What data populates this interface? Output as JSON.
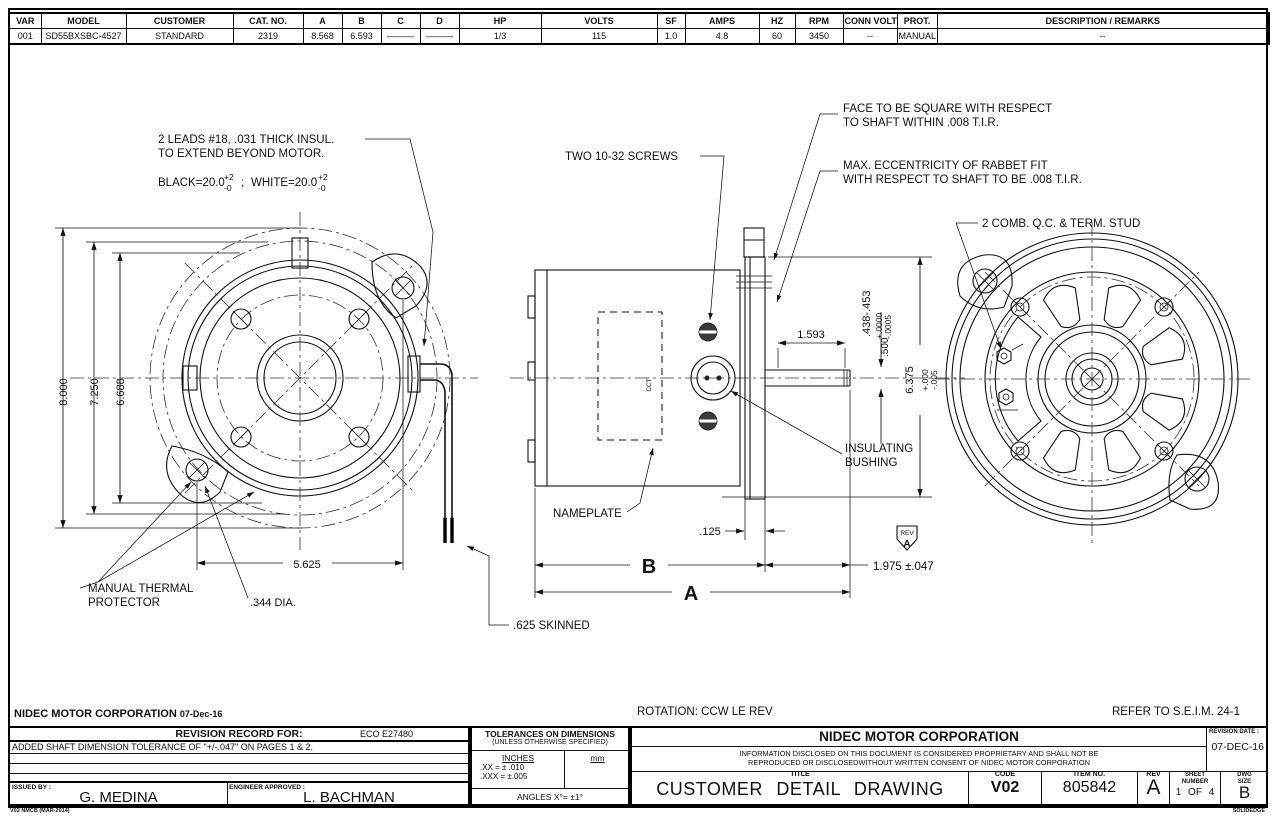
{
  "spec_table": {
    "headers": [
      "VAR",
      "MODEL",
      "CUSTOMER",
      "CAT. NO.",
      "A",
      "B",
      "C",
      "D",
      "HP",
      "VOLTS",
      "SF",
      "AMPS",
      "HZ",
      "RPM",
      "CONN VOLTS",
      "PROT.",
      "DESCRIPTION / REMARKS"
    ],
    "row": [
      "001",
      "SD55BXSBC-4527",
      "STANDARD",
      "2319",
      "8.568",
      "6.593",
      "———",
      "———",
      "1/3",
      "115",
      "1.0",
      "4.8",
      "60",
      "3450",
      "--",
      "MANUAL",
      "--"
    ]
  },
  "front_view": {
    "dim_8000": "8.000",
    "dim_7250": "7.250",
    "dim_6688": "6.688",
    "dim_5625": "5.625",
    "dim_344": ".344 DIA.",
    "thermal_1": "MANUAL THERMAL",
    "thermal_2": "PROTECTOR",
    "leads_1": "2 LEADS #18, .031 THICK INSUL.",
    "leads_2": "TO EXTEND BEYOND MOTOR.",
    "leads_black": "BLACK=20.0",
    "leads_white": "WHITE=20.0",
    "tol_plus": "+2",
    "tol_minus": "-0",
    "semicolon": ";"
  },
  "side_view": {
    "two_screws": "TWO 10-32 SCREWS",
    "face_1": "FACE TO BE SQUARE WITH RESPECT",
    "face_2": "TO SHAFT WITHIN .008 T.I.R.",
    "ecc_1": "MAX. ECCENTRICITY OF RABBET FIT",
    "ecc_2": "WITH RESPECT TO SHAFT TO BE .008 T.I.R.",
    "nameplate": "NAMEPLATE",
    "nameplate_mark": "CCT",
    "insulating_1": "INSULATING",
    "insulating_2": "BUSHING",
    "skinned": ".625 SKINNED",
    "dim_1593": "1.593",
    "dim_438": ".438-.453",
    "dim_438_p": "+.0000",
    "dim_438_m": "-.0005",
    "dim_500": ".500",
    "dim_6375": "6.375",
    "dim_6375_p": "+.000",
    "dim_6375_m": "-.005",
    "dim_125": ".125",
    "dim_B": "B",
    "dim_A": "A",
    "dim_1975": "1.975 ±.047",
    "rev_flag_label": "REV",
    "rev_flag": "A"
  },
  "rear_view": {
    "comb": "2 COMB. Q.C. & TERM. STUD"
  },
  "notes": {
    "rotation": "ROTATION: CCW LE REV",
    "refer": "REFER TO S.E.I.M. 24-1"
  },
  "footer": {
    "company": "NIDEC MOTOR CORPORATION",
    "date": "07-Dec-16",
    "stamp": "V02  NMCB (MAR-2014)",
    "cad": "SOLIDEDGE"
  },
  "revision_record": {
    "title": "REVISION RECORD FOR:",
    "eco": "ECO E27480",
    "row1": "ADDED SHAFT DIMENSION TOLERANCE OF \"+/-.047\" ON PAGES 1 & 2.",
    "issued_by_label": "ISSUED BY :",
    "issued_by": "G. MEDINA",
    "engineer_label": "ENGINEER APPROVED :",
    "engineer": "L. BACHMAN"
  },
  "tolerances": {
    "title": "TOLERANCES ON DIMENSIONS",
    "subtitle": "(UNLESS OTHERWISE SPECIFIED)",
    "inches_label": "INCHES",
    "mm_label": "mm",
    "xx": ".XX = ± .010",
    "xxx": ".XXX = ±.005",
    "angles": "ANGLES  X°= ±1°"
  },
  "title_block": {
    "company": "NIDEC MOTOR CORPORATION",
    "proprietary_1": "INFORMATION DISCLOSED ON THIS DOCUMENT IS CONSIDERED PROPRIETARY AND SHALL NOT BE",
    "proprietary_2": "REPRODUCED OR DISCLOSEDWITHOUT WRITTEN CONSENT OF NIDEC MOTOR CORPORATION",
    "revision_date_label": "REVISION DATE :",
    "revision_date": "07-DEC-16",
    "title_label": "TITLE",
    "title": "CUSTOMER DETAIL DRAWING",
    "code_label": "CODE",
    "code": "V02",
    "item_label": "ITEM NO.",
    "item": "805842",
    "rev_label": "REV",
    "rev": "A",
    "sheet_label_1": "SHEET",
    "sheet_label_2": "NUMBER",
    "sheet": "1 OF 4",
    "size_label_1": "DWG",
    "size_label_2": "SIZE",
    "size": "B"
  }
}
